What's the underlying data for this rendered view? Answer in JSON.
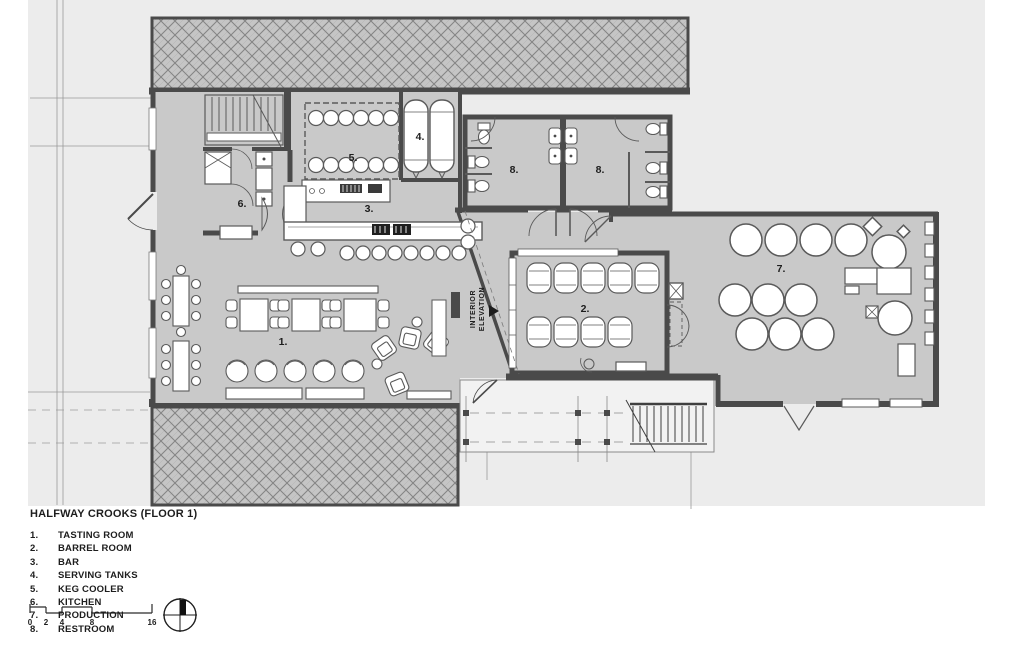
{
  "title": "HALFWAY CROOKS (FLOOR 1)",
  "legend": [
    {
      "num": "1.",
      "label": "TASTING ROOM"
    },
    {
      "num": "2.",
      "label": "BARREL ROOM"
    },
    {
      "num": "3.",
      "label": "BAR"
    },
    {
      "num": "4.",
      "label": "SERVING TANKS"
    },
    {
      "num": "5.",
      "label": "KEG COOLER"
    },
    {
      "num": "6.",
      "label": "KITCHEN"
    },
    {
      "num": "7.",
      "label": "PRODUCTION"
    },
    {
      "num": "8.",
      "label": "RESTROOM"
    }
  ],
  "plan": {
    "room_labels": {
      "tasting_room": "1.",
      "barrel_room": "2.",
      "bar": "3.",
      "serving_tanks": "4.",
      "keg_cooler": "5.",
      "kitchen": "6.",
      "production": "7.",
      "restroom_left": "8.",
      "restroom_right": "8."
    },
    "annotations": {
      "interior_elevation_line1": "INTERIOR",
      "interior_elevation_line2": "ELEVATION"
    }
  },
  "scale_bar": {
    "ticks": [
      "0",
      "2",
      "4",
      "8",
      "16"
    ]
  },
  "icons": {
    "north_arrow": "compass-north-arrow-icon"
  },
  "colors": {
    "wall": "#4a4a4a",
    "floor": "#c9c9c9",
    "backdrop": "#ececec",
    "hatch_bg": "#c5c5c5",
    "line": "#9a9a9a",
    "text": "#1d1d1d"
  }
}
